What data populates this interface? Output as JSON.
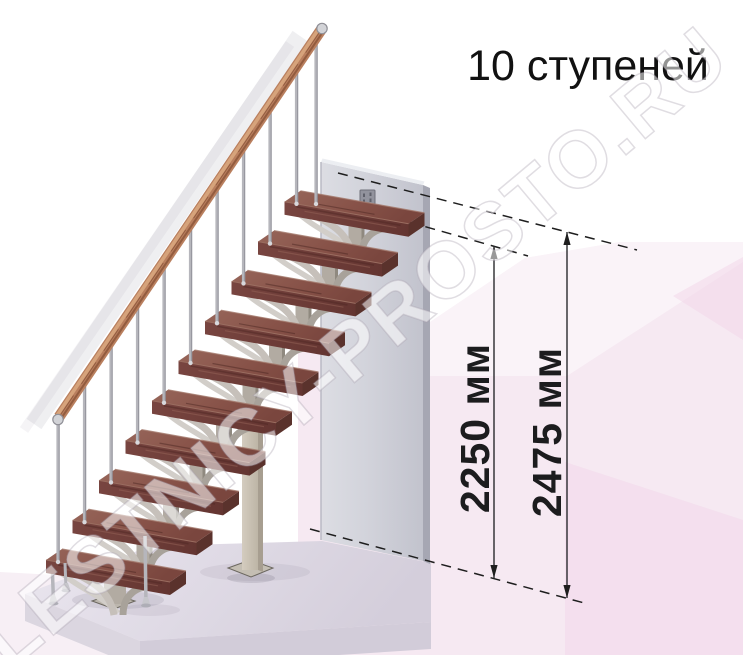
{
  "title": "10 ступеней",
  "watermark": "LESTNICY-PROSTO.RU",
  "dims": [
    {
      "name": "height-to-last-tread",
      "label": "2250 мм"
    },
    {
      "name": "total-height",
      "label": "2475 мм"
    }
  ],
  "stairs": {
    "steps": 10,
    "origin": [
      46,
      560
    ],
    "step_dx": 26.5,
    "step_dy": 39.8,
    "tread_w": [
      124,
      22
    ],
    "tread_d": [
      16,
      -11
    ],
    "tread_thickness": 13,
    "balusters_per_step": 1
  },
  "colors": {
    "tread_top": "#8a564c",
    "tread_front": "#6e3d38",
    "tread_end": "#5a322c",
    "handrail": "#b97f5e",
    "handrail_highlight": "#daa87f",
    "metal": "#b6b6bc",
    "stringer": "#b2aba2",
    "gusset_light": "#c6c0ba",
    "gusset_dark": "#a8a29a",
    "column": "#cfc8bb",
    "wall": "#d0d1d9",
    "plinth": "#dfdae4",
    "floor_pink": "#f6e9f2",
    "dimension_ink": "#1e1e1e"
  }
}
